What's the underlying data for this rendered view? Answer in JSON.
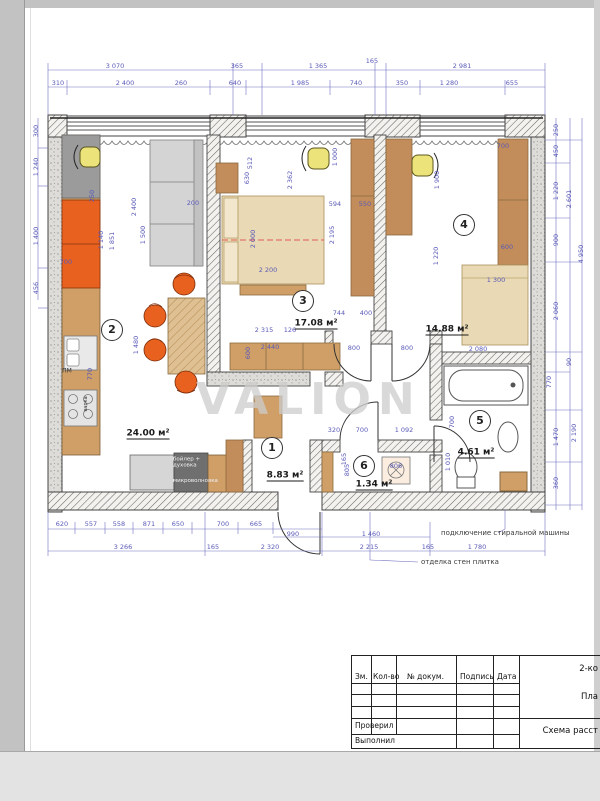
{
  "watermark": "VALION",
  "rooms": [
    {
      "number": "1",
      "area": "8.83 м²",
      "cx": 272,
      "cy": 448,
      "ax": 285,
      "ay": 476
    },
    {
      "number": "2",
      "area": "24.00 м²",
      "cx": 112,
      "cy": 330,
      "ax": 148,
      "ay": 434
    },
    {
      "number": "3",
      "area": "17.08 м²",
      "cx": 303,
      "cy": 301,
      "ax": 316,
      "ay": 324
    },
    {
      "number": "4",
      "area": "14.88 м²",
      "cx": 464,
      "cy": 225,
      "ax": 447,
      "ay": 330
    },
    {
      "number": "5",
      "area": "4.61 м²",
      "cx": 480,
      "cy": 421,
      "ax": 476,
      "ay": 453
    },
    {
      "number": "6",
      "area": "1.34 м²",
      "cx": 364,
      "cy": 466,
      "ax": 374,
      "ay": 485
    }
  ],
  "notes": [
    {
      "text": "подключение стиральной машины",
      "x": 441,
      "y": 533
    },
    {
      "text": "отделка стен плитка",
      "x": 421,
      "y": 562
    }
  ],
  "labels": [
    {
      "text": "ПМ",
      "x": 67,
      "y": 371
    },
    {
      "text": "варка",
      "x": 86,
      "y": 404,
      "v": true
    },
    {
      "text": "бойлер + духовка",
      "x": 190,
      "y": 463,
      "white": true
    },
    {
      "text": "микроволновка",
      "x": 190,
      "y": 481,
      "white": true
    }
  ],
  "dimensions": [
    {
      "t": "3 070",
      "x": 115,
      "y": 66
    },
    {
      "t": "365",
      "x": 237,
      "y": 66
    },
    {
      "t": "1 365",
      "x": 318,
      "y": 66
    },
    {
      "t": "165",
      "x": 372,
      "y": 61
    },
    {
      "t": "2 981",
      "x": 462,
      "y": 66
    },
    {
      "t": "310",
      "x": 58,
      "y": 83
    },
    {
      "t": "2 400",
      "x": 125,
      "y": 83
    },
    {
      "t": "260",
      "x": 181,
      "y": 83
    },
    {
      "t": "640",
      "x": 235,
      "y": 83
    },
    {
      "t": "1 985",
      "x": 300,
      "y": 83
    },
    {
      "t": "740",
      "x": 356,
      "y": 83
    },
    {
      "t": "350",
      "x": 402,
      "y": 83
    },
    {
      "t": "1 280",
      "x": 449,
      "y": 83
    },
    {
      "t": "655",
      "x": 512,
      "y": 83
    },
    {
      "t": "620",
      "x": 62,
      "y": 524
    },
    {
      "t": "557",
      "x": 91,
      "y": 524
    },
    {
      "t": "558",
      "x": 119,
      "y": 524
    },
    {
      "t": "871",
      "x": 149,
      "y": 524
    },
    {
      "t": "650",
      "x": 178,
      "y": 524
    },
    {
      "t": "700",
      "x": 223,
      "y": 524
    },
    {
      "t": "665",
      "x": 256,
      "y": 524
    },
    {
      "t": "990",
      "x": 293,
      "y": 534
    },
    {
      "t": "3 266",
      "x": 123,
      "y": 547
    },
    {
      "t": "165",
      "x": 213,
      "y": 547
    },
    {
      "t": "2 320",
      "x": 270,
      "y": 547
    },
    {
      "t": "1 460",
      "x": 371,
      "y": 534
    },
    {
      "t": "2 215",
      "x": 369,
      "y": 547
    },
    {
      "t": "165",
      "x": 428,
      "y": 547
    },
    {
      "t": "1 780",
      "x": 477,
      "y": 547
    },
    {
      "t": "300",
      "x": 36,
      "y": 131,
      "r": 1
    },
    {
      "t": "1 240",
      "x": 36,
      "y": 167,
      "r": 1
    },
    {
      "t": "1 400",
      "x": 36,
      "y": 236,
      "r": 1
    },
    {
      "t": "456",
      "x": 36,
      "y": 288,
      "r": 1
    },
    {
      "t": "250",
      "x": 556,
      "y": 130,
      "r": 1
    },
    {
      "t": "450",
      "x": 556,
      "y": 151,
      "r": 1
    },
    {
      "t": "1 220",
      "x": 556,
      "y": 191,
      "r": 1
    },
    {
      "t": "900",
      "x": 556,
      "y": 240,
      "r": 1
    },
    {
      "t": "2 601",
      "x": 569,
      "y": 199,
      "r": 1
    },
    {
      "t": "4 950",
      "x": 581,
      "y": 254,
      "r": 1
    },
    {
      "t": "2 060",
      "x": 556,
      "y": 311,
      "r": 1
    },
    {
      "t": "90",
      "x": 569,
      "y": 362,
      "r": 1
    },
    {
      "t": "770",
      "x": 549,
      "y": 382,
      "r": 1
    },
    {
      "t": "1 470",
      "x": 556,
      "y": 437,
      "r": 1
    },
    {
      "t": "2 190",
      "x": 574,
      "y": 433,
      "r": 1
    },
    {
      "t": "360",
      "x": 556,
      "y": 483,
      "r": 1
    },
    {
      "t": "700",
      "x": 66,
      "y": 262
    },
    {
      "t": "250",
      "x": 92,
      "y": 196,
      "r": 1
    },
    {
      "t": "1 140",
      "x": 101,
      "y": 240,
      "r": 1
    },
    {
      "t": "1 851",
      "x": 112,
      "y": 241,
      "r": 1
    },
    {
      "t": "2 400",
      "x": 134,
      "y": 207,
      "r": 1
    },
    {
      "t": "1 500",
      "x": 143,
      "y": 235,
      "r": 1
    },
    {
      "t": "200",
      "x": 193,
      "y": 203
    },
    {
      "t": "770",
      "x": 90,
      "y": 374,
      "r": 1
    },
    {
      "t": "1 480",
      "x": 136,
      "y": 345,
      "r": 1
    },
    {
      "t": "512",
      "x": 250,
      "y": 163,
      "r": 1
    },
    {
      "t": "630",
      "x": 247,
      "y": 178,
      "r": 1
    },
    {
      "t": "2 362",
      "x": 290,
      "y": 180,
      "r": 1
    },
    {
      "t": "1 000",
      "x": 335,
      "y": 157,
      "r": 1
    },
    {
      "t": "2 000",
      "x": 253,
      "y": 239,
      "r": 1
    },
    {
      "t": "594",
      "x": 335,
      "y": 204
    },
    {
      "t": "550",
      "x": 365,
      "y": 204
    },
    {
      "t": "2 195",
      "x": 332,
      "y": 235,
      "r": 1
    },
    {
      "t": "2 200",
      "x": 268,
      "y": 270
    },
    {
      "t": "2 315",
      "x": 264,
      "y": 330
    },
    {
      "t": "126",
      "x": 290,
      "y": 330
    },
    {
      "t": "2 440",
      "x": 270,
      "y": 347
    },
    {
      "t": "600",
      "x": 248,
      "y": 353,
      "r": 1
    },
    {
      "t": "744",
      "x": 339,
      "y": 313
    },
    {
      "t": "400",
      "x": 366,
      "y": 313
    },
    {
      "t": "800",
      "x": 354,
      "y": 348
    },
    {
      "t": "800",
      "x": 407,
      "y": 348
    },
    {
      "t": "700",
      "x": 503,
      "y": 146
    },
    {
      "t": "1 900",
      "x": 437,
      "y": 180,
      "r": 1
    },
    {
      "t": "1 220",
      "x": 436,
      "y": 256,
      "r": 1
    },
    {
      "t": "600",
      "x": 507,
      "y": 247
    },
    {
      "t": "1 300",
      "x": 496,
      "y": 280
    },
    {
      "t": "2 080",
      "x": 478,
      "y": 349
    },
    {
      "t": "320",
      "x": 334,
      "y": 430
    },
    {
      "t": "700",
      "x": 362,
      "y": 430
    },
    {
      "t": "1 092",
      "x": 404,
      "y": 430
    },
    {
      "t": "165",
      "x": 344,
      "y": 459,
      "r": 1
    },
    {
      "t": "805",
      "x": 347,
      "y": 470,
      "r": 1
    },
    {
      "t": "806",
      "x": 396,
      "y": 466
    },
    {
      "t": "700",
      "x": 452,
      "y": 422,
      "r": 1
    },
    {
      "t": "1 010",
      "x": 448,
      "y": 462,
      "r": 1
    }
  ],
  "titleblock": {
    "col_zm": "Зм.",
    "col_kol": "Кол-во",
    "col_doc": "№ докум.",
    "col_sign": "Подпись",
    "col_date": "Дата",
    "row_checked": "Проверил",
    "row_done": "Выполнил",
    "right_top": "2-ко",
    "right_mid": "Пла",
    "right_bottom": "Схема расст"
  }
}
